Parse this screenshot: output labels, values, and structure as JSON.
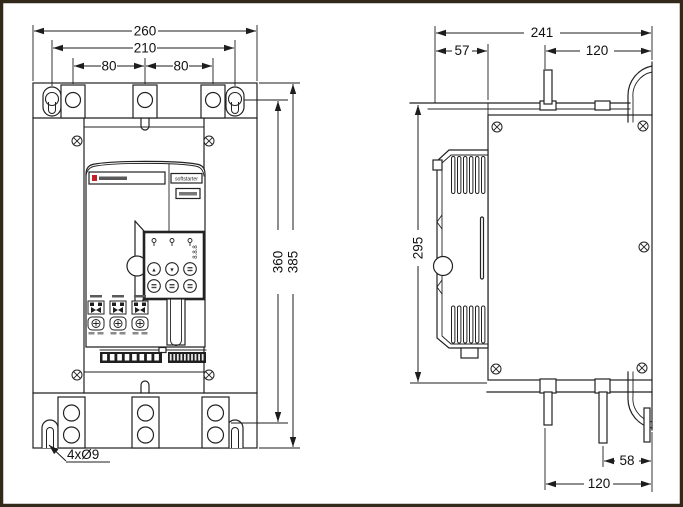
{
  "dims": {
    "front_width_overall": "260",
    "front_width_mount": "210",
    "front_pitch_left": "80",
    "front_pitch_right": "80",
    "front_height_mount": "360",
    "front_height_overall": "385",
    "front_mount_holes": "4xØ9",
    "side_depth_overall": "241",
    "side_depth_front": "57",
    "side_depth_top": "120",
    "side_height": "295",
    "side_tab_offset": "58",
    "side_depth_bottom": "120"
  },
  "panel": {
    "product_label": "softstarter",
    "display_value": "8.8.8",
    "btn_up": "▲",
    "btn_down": "▼"
  },
  "colors": {
    "line": "#222222",
    "frame": "#32291b",
    "accent_red": "#c42127",
    "paper": "#ffffff"
  }
}
